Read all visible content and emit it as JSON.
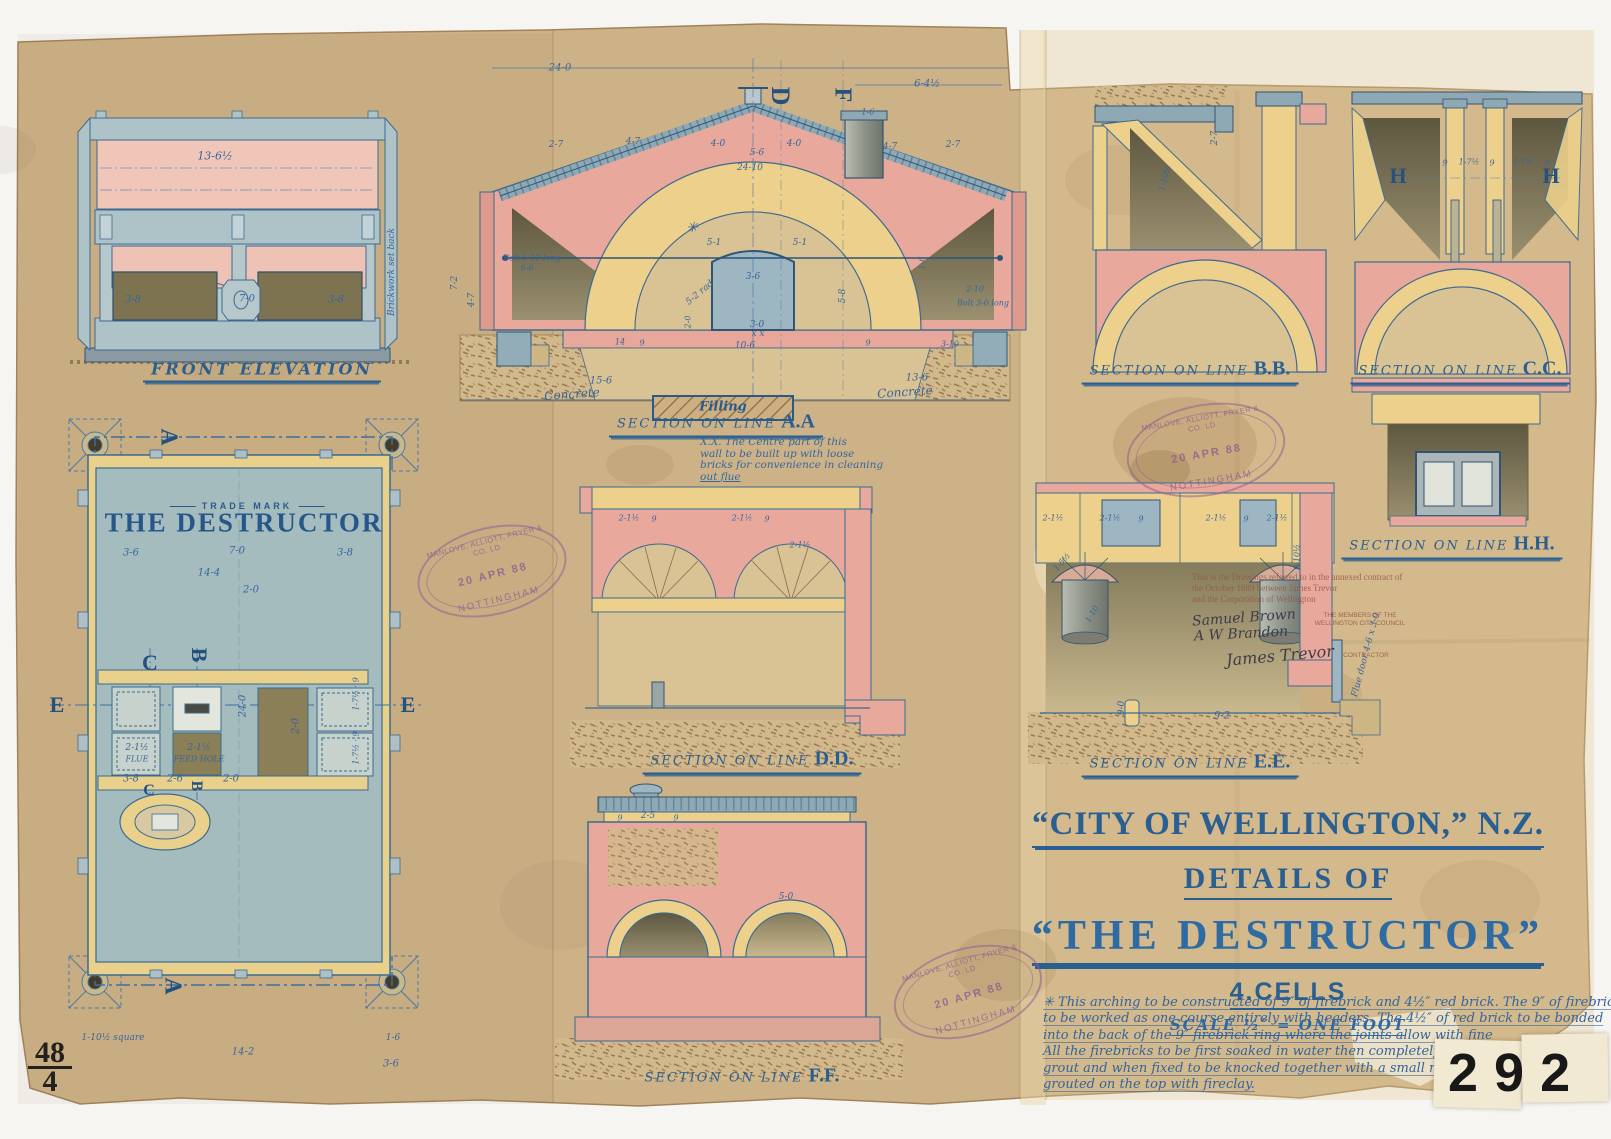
{
  "sheet": {
    "numbers": {
      "archive_number": "292",
      "plate_number": "48",
      "plate_sub": "4",
      "faint_ref": "K1173"
    },
    "title_block": {
      "city_line": "“CITY OF WELLINGTON,” N.Z.",
      "details_line": "DETAILS OF",
      "name_line": "“THE DESTRUCTOR”",
      "cells_line": "4.CELLS",
      "scale_line": "SCALE ½″ = ONE FOOT",
      "spec_note_lines": [
        "✳ This arching to be constructed of 9″ of firebrick and 4½″ red brick. The 9″ of firebrick",
        "to be worked as one course entirely with headers. The 4½″ of red brick to be bonded",
        "into the back of the 9″ firebrick ring where the joints allow with fine",
        "All the firebricks to be first soaked in water then completely dipped in",
        "grout and when fixed to be knocked together with a small mallet",
        "grouted on the top with fireclay."
      ]
    },
    "stamp": {
      "maker": "MANLOVE, ALLIOTT, FRYER & CO. LD",
      "date": "20 APR 88",
      "city": "NOTTINGHAM"
    },
    "contract_note": {
      "typed_lines": [
        "This is the Drawings referred to in the annexed contract of",
        "the October 1889 between James Trevor",
        "and the Corporation of Wellington"
      ],
      "signature_1": "Samuel Brown",
      "signature_2": "A W Brandon",
      "signature_3": "James Trevor",
      "party_caption": "THE MEMBERS OF THE WELLINGTON CITY COUNCIL",
      "contractor_caption": "CONTRACTOR"
    },
    "views": {
      "front_elevation": {
        "label": "FRONT ELEVATION"
      },
      "plan": {
        "trade_mark": "TRADE MARK",
        "name": "THE DESTRUCTOR"
      },
      "section_aa": {
        "prefix": "SECTION ON LINE",
        "id": "A.A",
        "filling_label": "Filling",
        "note_lines": [
          "X.X. The Centre part of this",
          "wall to be built up with loose",
          "bricks for convenience in cleaning",
          "out flue"
        ]
      },
      "section_bb": {
        "prefix": "SECTION ON LINE",
        "id": "B.B."
      },
      "section_cc": {
        "prefix": "SECTION ON LINE",
        "id": "C.C."
      },
      "section_dd": {
        "prefix": "SECTION ON LINE",
        "id": "D.D."
      },
      "section_ee": {
        "prefix": "SECTION ON LINE",
        "id": "E.E."
      },
      "section_ff": {
        "prefix": "SECTION ON LINE",
        "id": "F.F."
      },
      "section_hh": {
        "prefix": "SECTION ON LINE",
        "id": "H.H."
      }
    },
    "letters": [
      [
        "A",
        168,
        437,
        90,
        24
      ],
      [
        "A",
        172,
        986,
        90,
        24
      ],
      [
        "C",
        150,
        663,
        0,
        22
      ],
      [
        "B",
        199,
        655,
        90,
        22
      ],
      [
        "E",
        57,
        705,
        0,
        22
      ],
      [
        "E",
        408,
        705,
        0,
        22
      ],
      [
        "C",
        149,
        791,
        0,
        16
      ],
      [
        "B",
        196,
        786,
        90,
        16
      ],
      [
        "D",
        780,
        96,
        90,
        26
      ],
      [
        "F",
        842,
        95,
        90,
        24
      ],
      [
        "H",
        1398,
        176,
        0,
        22
      ],
      [
        "H",
        1551,
        176,
        0,
        22
      ]
    ],
    "dimensions": [
      [
        "13-6½",
        215,
        156,
        0,
        11
      ],
      [
        "3-8",
        133,
        300
      ],
      [
        "7-0",
        247,
        299
      ],
      [
        "3-8",
        336,
        300
      ],
      [
        "Brickwork set back",
        392,
        272,
        -90,
        9
      ],
      [
        "3-6",
        131,
        553
      ],
      [
        "7-0",
        237,
        551
      ],
      [
        "3-8",
        345,
        553
      ],
      [
        "14-4",
        209,
        573
      ],
      [
        "2-0",
        251,
        590
      ],
      [
        "24-0",
        243,
        706,
        -90
      ],
      [
        "2-0",
        296,
        726,
        -90
      ],
      [
        "2-1½",
        137,
        748,
        0,
        9
      ],
      [
        "FLUE",
        137,
        759,
        0,
        8
      ],
      [
        "2-1½",
        199,
        748,
        0,
        9
      ],
      [
        "FEED HOLE",
        199,
        759,
        0,
        8
      ],
      [
        "1-7½ · 9",
        356,
        694,
        -90,
        8
      ],
      [
        "1-7½ · 9",
        356,
        748,
        -90,
        8
      ],
      [
        "3-8",
        131,
        779
      ],
      [
        "2-6",
        175,
        779
      ],
      [
        "2-0",
        231,
        779
      ],
      [
        "1-10½ square",
        113,
        1038,
        0,
        9
      ],
      [
        "1-6",
        393,
        1038,
        0,
        9
      ],
      [
        "3-6",
        391,
        1064
      ],
      [
        "14-2",
        243,
        1052
      ],
      [
        "24-0",
        560,
        68
      ],
      [
        "6-4½",
        927,
        84
      ],
      [
        "2-7",
        556,
        145,
        0,
        9
      ],
      [
        "4-7",
        633,
        142,
        0,
        9
      ],
      [
        "4-0",
        718,
        144,
        0,
        9
      ],
      [
        "5-6",
        757,
        153,
        0,
        9
      ],
      [
        "4-0",
        794,
        144,
        0,
        9
      ],
      [
        "24-10",
        750,
        168,
        0,
        9
      ],
      [
        "4-7",
        890,
        147,
        0,
        9
      ],
      [
        "2-7",
        953,
        145,
        0,
        9
      ],
      [
        "1-6",
        868,
        112,
        0,
        8
      ],
      [
        "7-2",
        455,
        283,
        -90,
        9
      ],
      [
        "4-7",
        472,
        300,
        -90,
        9
      ],
      [
        "Bolt 5-10 long",
        532,
        258,
        0,
        8
      ],
      [
        "6-6",
        527,
        268,
        0,
        8
      ],
      [
        "5-1",
        714,
        243,
        0,
        9
      ],
      [
        "5-1",
        800,
        243,
        0,
        9
      ],
      [
        "3-6",
        753,
        277,
        0,
        9
      ],
      [
        "5-2 rad",
        700,
        293,
        -40,
        9
      ],
      [
        "5-8",
        843,
        296,
        -90,
        9
      ],
      [
        "2-0",
        688,
        322,
        -90,
        8
      ],
      [
        "3-0",
        757,
        325,
        0,
        9
      ],
      [
        "x x",
        758,
        334,
        0,
        9
      ],
      [
        "10-6",
        745,
        346,
        0,
        9
      ],
      [
        "14",
        620,
        342,
        0,
        8
      ],
      [
        "9",
        642,
        343,
        0,
        8
      ],
      [
        "9",
        868,
        343,
        0,
        8
      ],
      [
        "3-10",
        950,
        344,
        0,
        8
      ],
      [
        "2-10",
        975,
        289,
        0,
        8
      ],
      [
        "Bolt 3-0 long",
        983,
        303,
        0,
        8
      ],
      [
        "1-6",
        922,
        263,
        -90,
        8
      ],
      [
        "✳",
        692,
        228,
        0,
        14
      ],
      [
        "15-6",
        601,
        381,
        0,
        10
      ],
      [
        "13-6",
        917,
        378,
        0,
        10
      ],
      [
        "Concrete",
        572,
        394,
        -4,
        12
      ],
      [
        "Concrete",
        905,
        392,
        -4,
        12
      ],
      [
        "2-7",
        1215,
        138,
        -90,
        9
      ],
      [
        "1-10½",
        1165,
        178,
        -75,
        8
      ],
      [
        "9",
        1445,
        163,
        0,
        8
      ],
      [
        "1-7½",
        1469,
        162,
        0,
        8
      ],
      [
        "9",
        1492,
        163,
        0,
        8
      ],
      [
        "1-7½",
        1523,
        162,
        0,
        8
      ],
      [
        "9",
        1547,
        163,
        0,
        8
      ],
      [
        "2-1½",
        629,
        518,
        0,
        8
      ],
      [
        "9",
        654,
        519,
        0,
        8
      ],
      [
        "2-1½",
        742,
        518,
        0,
        8
      ],
      [
        "9",
        767,
        519,
        0,
        8
      ],
      [
        "2-1½",
        800,
        545,
        0,
        8
      ],
      [
        "2-1½",
        1053,
        518,
        0,
        8
      ],
      [
        "2-1½",
        1110,
        518,
        0,
        8
      ],
      [
        "9",
        1141,
        519,
        0,
        8
      ],
      [
        "2-1½",
        1216,
        518,
        0,
        8
      ],
      [
        "9",
        1246,
        519,
        0,
        8
      ],
      [
        "2-1½",
        1277,
        518,
        0,
        8
      ],
      [
        "1-5½",
        1062,
        562,
        -50,
        8
      ],
      [
        "1-10",
        1092,
        614,
        -60,
        8
      ],
      [
        "9-0",
        1122,
        708,
        -90,
        9
      ],
      [
        "9-2",
        1222,
        716,
        0,
        10
      ],
      [
        "Flue door 4-6 x 3-0",
        1366,
        655,
        -75,
        9
      ],
      [
        "9-10½",
        1297,
        557,
        -90,
        8
      ],
      [
        "9",
        620,
        818,
        0,
        8
      ],
      [
        "2-5",
        648,
        816,
        0,
        9
      ],
      [
        "9",
        676,
        818,
        0,
        8
      ],
      [
        "5-0",
        786,
        897,
        0,
        9
      ]
    ]
  }
}
